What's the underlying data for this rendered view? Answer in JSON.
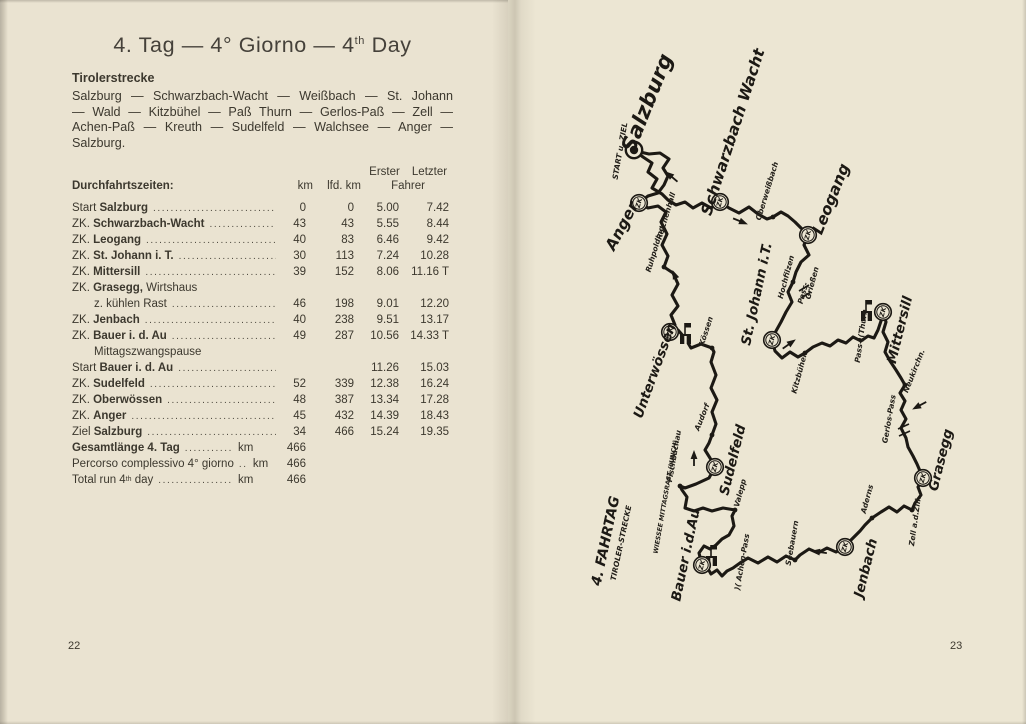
{
  "colors": {
    "page_left": "#eae3d1",
    "page_right": "#ece6d3",
    "ink": "#3c382e",
    "map_ink": "#1c1914"
  },
  "left_page": {
    "page_number": "22",
    "title": {
      "before": "4. Tag — 4° Giorno — 4",
      "sup": "th",
      "after": " Day"
    },
    "section_heading": "Tirolerstrecke",
    "route_paragraph": "Salzburg — Schwarzbach-Wacht — Weißbach — St. Johann — Wald — Kitzbühel — Paß Thurn — Gerlos-Paß — Zell — Achen-Paß — Kreuth — Sudelfeld — Walchsee — Anger — Salzburg.",
    "table": {
      "header": {
        "col1": "Durchfahrtszeiten:",
        "km": "km",
        "lfd": "lfd. km",
        "erster": "Erster",
        "letzter": "Letzter",
        "fahrer": "Fahrer"
      },
      "rows": [
        {
          "pre": "Start ",
          "bold": "Salzburg",
          "dots": 1,
          "km": "0",
          "lfd": "0",
          "e": "5.00",
          "l": "7.42"
        },
        {
          "pre": "ZK. ",
          "bold": "Schwarzbach-Wacht",
          "dots": 1,
          "km": "43",
          "lfd": "43",
          "e": "5.55",
          "l": "8.44"
        },
        {
          "pre": "ZK. ",
          "bold": "Leogang",
          "dots": 1,
          "km": "40",
          "lfd": "83",
          "e": "6.46",
          "l": "9.42"
        },
        {
          "pre": "ZK. ",
          "bold": "St. Johann i. T.",
          "dots": 1,
          "km": "30",
          "lfd": "113",
          "e": "7.24",
          "l": "10.28"
        },
        {
          "pre": "ZK. ",
          "bold": "Mittersill",
          "dots": 1,
          "km": "39",
          "lfd": "152",
          "e": "8.06",
          "l": "11.16 T"
        },
        {
          "pre": "ZK. ",
          "bold": "Grasegg,",
          "post": " Wirtshaus",
          "dots": 0
        },
        {
          "ind": 1,
          "pre": "z. kühlen Rast",
          "dots": 1,
          "km": "46",
          "lfd": "198",
          "e": "9.01",
          "l": "12.20"
        },
        {
          "pre": "ZK. ",
          "bold": "Jenbach",
          "dots": 1,
          "km": "40",
          "lfd": "238",
          "e": "9.51",
          "l": "13.17"
        },
        {
          "pre": "ZK. ",
          "bold": "Bauer i. d. Au",
          "dots": 1,
          "km": "49",
          "lfd": "287",
          "e": "10.56",
          "l": "14.33 T"
        },
        {
          "ind": 1,
          "pre": "Mittagszwangspause",
          "dots": 0
        },
        {
          "pre": "Start ",
          "bold": "Bauer i. d. Au",
          "dots": 1,
          "e": "11.26",
          "l": "15.03"
        },
        {
          "pre": "ZK. ",
          "bold": "Sudelfeld",
          "dots": 1,
          "km": "52",
          "lfd": "339",
          "e": "12.38",
          "l": "16.24"
        },
        {
          "pre": "ZK. ",
          "bold": "Oberwössen",
          "dots": 1,
          "km": "48",
          "lfd": "387",
          "e": "13.34",
          "l": "17.28"
        },
        {
          "pre": "ZK. ",
          "bold": "Anger",
          "dots": 1,
          "km": "45",
          "lfd": "432",
          "e": "14.39",
          "l": "18.43"
        },
        {
          "pre": "Ziel ",
          "bold": "Salzburg",
          "dots": 1,
          "km": "34",
          "lfd": "466",
          "e": "15.24",
          "l": "19.35"
        },
        {
          "bold": "Gesamtlänge 4. Tag",
          "dots": 1,
          "unit": "km",
          "km": "466"
        },
        {
          "pre": "Percorso complessivo 4° giorno",
          "dots": 1,
          "unit": "km",
          "km": "466"
        },
        {
          "pre": "Total run 4",
          "sup": "th",
          "post": " day",
          "dots": 1,
          "unit": "km",
          "km": "466"
        }
      ]
    }
  },
  "right_page": {
    "page_number": "23",
    "map": {
      "zk_label": "ZK",
      "route": "M634,150 L643,157 L652,163 L648,172 L657,179 L652,188 L662,194 L668,200 L676,205 L685,202 L693,208 L702,203 L711,208 L720,202 L729,208 L739,213 L749,207 L758,214 L767,219 L773,217 L781,212 L788,216 L795,222 L801,228 L808,235 L804,245 L809,255 L801,262 L796,272 L793,282 L788,292 L792,302 L786,312 L781,322 L776,331 L772,340 L775,351 L782,358 L790,352 L798,357 L805,353 L813,347 L822,343 L830,346 L838,340 L846,343 L853,337 L861,341 L868,336 L874,338 L878,330 L881,321 L883,312 L886,322 L883,332 L888,342 L885,352 L890,361 L896,370 L901,378 L905,385 L900,393 L905,401 L901,410 L906,419 L901,428 L906,438 L908,447 L913,456 L917,464 L920,471 L923,478 L918,487 L921,495 L915,503 L912,510 L904,506 L897,512 L889,507 L881,512 L875,516 L872,518 L865,525 L860,531 L854,537 L849,542 L845,547 L836,552 L827,548 L818,553 L809,549 L800,555 L795,560 L786,556 L777,562 L768,557 L758,563 L748,558 L740,563 L733,568 L727,571 L722,576 L717,570 L711,574 L707,567 L702,565 L699,553 L704,546 L710,549 L716,545 L722,539 L729,535 L734,526 L732,516 L735,510 L723,508 L712,511 L703,508 L694,511 L685,508 L687,497 L682,490 L680,486 L685,488 L696,484 L709,478 L715,467 L710,458 L705,450 L709,443 L712,435 L716,424 L712,412 L717,400 L711,388 L716,375 L711,362 L714,352 L712,348 L701,344 L691,348 L685,338 L678,330 L670,332 L675,325 L671,315 L678,306 L672,295 L678,284 L673,273 L664,267 L668,256 L662,245 L667,234 L661,222 L666,212 L658,206 L648,208 L639,203 L648,196 L658,193 L664,185 L668,176 L663,168 L669,159 L660,153 L649,154 L640,152 Z",
      "start_marker": {
        "x": 634,
        "y": 150
      },
      "checkpoints": [
        {
          "n": "anger",
          "x": 639,
          "y": 203
        },
        {
          "n": "schwarzbach-wacht",
          "x": 720,
          "y": 202
        },
        {
          "n": "leogang",
          "x": 808,
          "y": 235
        },
        {
          "n": "st-johann",
          "x": 772,
          "y": 340
        },
        {
          "n": "mittersill",
          "x": 883,
          "y": 312
        },
        {
          "n": "unterwoessen",
          "x": 670,
          "y": 332
        },
        {
          "n": "sudelfeld",
          "x": 715,
          "y": 467
        },
        {
          "n": "grasegg",
          "x": 923,
          "y": 478
        },
        {
          "n": "jenbach",
          "x": 845,
          "y": 547
        },
        {
          "n": "bauer-i-d-au",
          "x": 702,
          "y": 565
        }
      ],
      "towns": [
        {
          "n": "oberweissbach",
          "x": 773,
          "y": 217
        },
        {
          "n": "ruhpolding",
          "x": 664,
          "y": 267
        },
        {
          "n": "hochfilzen",
          "x": 793,
          "y": 282
        },
        {
          "n": "kitzbuehel",
          "x": 805,
          "y": 353
        },
        {
          "n": "koessen",
          "x": 712,
          "y": 348
        },
        {
          "n": "audorf",
          "x": 712,
          "y": 435
        },
        {
          "n": "fischbachau",
          "x": 680,
          "y": 486
        },
        {
          "n": "valepp",
          "x": 735,
          "y": 510
        },
        {
          "n": "neukirchen",
          "x": 905,
          "y": 385
        },
        {
          "n": "zell",
          "x": 912,
          "y": 510
        },
        {
          "n": "aderns",
          "x": 872,
          "y": 518
        },
        {
          "n": "seebauern",
          "x": 795,
          "y": 560
        }
      ],
      "buildings": [
        {
          "n": "unterwoessen",
          "x": 680,
          "y": 323
        },
        {
          "n": "mittersill",
          "x": 861,
          "y": 300
        },
        {
          "n": "bauer-i-d-au",
          "x": 706,
          "y": 545
        }
      ],
      "arrows": [
        {
          "x": 666,
          "y": 172,
          "a": -140
        },
        {
          "x": 747,
          "y": 224,
          "a": 22
        },
        {
          "x": 795,
          "y": 340,
          "a": -35
        },
        {
          "x": 913,
          "y": 409,
          "a": 152
        },
        {
          "x": 812,
          "y": 551,
          "a": 188
        },
        {
          "x": 694,
          "y": 451,
          "a": -90
        },
        {
          "x": 673,
          "y": 271,
          "a": -112
        }
      ],
      "pass_marks": [
        {
          "x1": 799,
          "y1": 291,
          "x2": 809,
          "y2": 285
        },
        {
          "x1": 801,
          "y1": 298,
          "x2": 811,
          "y2": 292
        },
        {
          "x1": 898,
          "y1": 429,
          "x2": 909,
          "y2": 424
        },
        {
          "x1": 899,
          "y1": 436,
          "x2": 910,
          "y2": 431
        }
      ],
      "labels": [
        {
          "t": "Salzburg",
          "x": 647,
          "y": 103,
          "r": -68,
          "s": 21,
          "c": "big"
        },
        {
          "t": "Schwarzbach Wacht",
          "x": 733,
          "y": 132,
          "r": -72,
          "s": 15.5,
          "c": "big"
        },
        {
          "t": "Leogang",
          "x": 831,
          "y": 199,
          "r": -68,
          "s": 15.5,
          "c": "big"
        },
        {
          "t": "Anger",
          "x": 622,
          "y": 226,
          "r": -62,
          "s": 15.5,
          "c": "big"
        },
        {
          "t": "St. Johann i.T.",
          "x": 757,
          "y": 294,
          "r": -78,
          "s": 13.5,
          "c": "big"
        },
        {
          "t": "Mittersill",
          "x": 900,
          "y": 330,
          "r": -76,
          "s": 13.5,
          "c": "big"
        },
        {
          "t": "Unterwössen",
          "x": 655,
          "y": 371,
          "r": -70,
          "s": 13.5,
          "c": "big"
        },
        {
          "t": "Sudelfeld",
          "x": 733,
          "y": 460,
          "r": -76,
          "s": 13.5,
          "c": "big"
        },
        {
          "t": "Grasegg",
          "x": 941,
          "y": 460,
          "r": -76,
          "s": 13.5,
          "c": "big"
        },
        {
          "t": "Jenbach",
          "x": 866,
          "y": 568,
          "r": -76,
          "s": 13.5,
          "c": "big"
        },
        {
          "t": "Bauer i.d.Au",
          "x": 686,
          "y": 555,
          "r": -78,
          "s": 13.5,
          "c": "big"
        },
        {
          "t": "4. FAHRTAG",
          "x": 606,
          "y": 541,
          "r": -78,
          "s": 14,
          "c": "big"
        },
        {
          "t": "TIROLER-STRECKE",
          "x": 621,
          "y": 543,
          "r": -78,
          "s": 7.5,
          "c": "sm"
        },
        {
          "t": "START u. ZIEL",
          "x": 620,
          "y": 151,
          "r": -80,
          "s": 7.5,
          "c": "sm"
        },
        {
          "t": "Oberweißbach",
          "x": 767,
          "y": 191,
          "r": -73,
          "s": 7.5,
          "c": "sm"
        },
        {
          "t": "Reichenhall",
          "x": 666,
          "y": 216,
          "r": -73,
          "s": 7.5,
          "c": "sm"
        },
        {
          "t": "Ruhpolding",
          "x": 655,
          "y": 249,
          "r": -73,
          "s": 7.5,
          "c": "sm"
        },
        {
          "t": "Hochfilzen",
          "x": 786,
          "y": 277,
          "r": -75,
          "s": 7.5,
          "c": "sm"
        },
        {
          "t": "Pass-",
          "x": 803,
          "y": 293,
          "r": -75,
          "s": 7.5,
          "c": "sm"
        },
        {
          "t": "Grießen",
          "x": 812,
          "y": 283,
          "r": -75,
          "s": 7.5,
          "c": "sm"
        },
        {
          "t": "Pass-)(Thurn",
          "x": 861,
          "y": 336,
          "r": -82,
          "s": 7.5,
          "c": "sm"
        },
        {
          "t": "Kitzbühel",
          "x": 799,
          "y": 374,
          "r": -75,
          "s": 7.5,
          "c": "sm"
        },
        {
          "t": "Kössen",
          "x": 706,
          "y": 331,
          "r": -72,
          "s": 7.5,
          "c": "sm"
        },
        {
          "t": "Audorf",
          "x": 702,
          "y": 417,
          "r": -68,
          "s": 7.5,
          "c": "sm"
        },
        {
          "t": "Fischbachau",
          "x": 674,
          "y": 456,
          "r": -80,
          "s": 7.5,
          "c": "sm"
        },
        {
          "t": "Valepp",
          "x": 740,
          "y": 493,
          "r": -75,
          "s": 7.5,
          "c": "sm"
        },
        {
          "t": "Neukirchn.",
          "x": 914,
          "y": 371,
          "r": -68,
          "s": 7.5,
          "c": "sm"
        },
        {
          "t": "Gerlos-Pass",
          "x": 889,
          "y": 419,
          "r": -80,
          "s": 7.5,
          "c": "sm"
        },
        {
          "t": "Zell a.d.Zill.",
          "x": 915,
          "y": 521,
          "r": -82,
          "s": 7.5,
          "c": "sm"
        },
        {
          "t": "Aderns",
          "x": 867,
          "y": 499,
          "r": -75,
          "s": 7.5,
          "c": "sm"
        },
        {
          "t": "Seebauern",
          "x": 792,
          "y": 543,
          "r": -80,
          "s": 7.5,
          "c": "sm"
        },
        {
          "t": ")( Achen-Pass",
          "x": 742,
          "y": 562,
          "r": -80,
          "s": 7.5,
          "c": "sm"
        },
        {
          "t": "WIESSEE MITTAGSRAST (LUNCH)",
          "x": 666,
          "y": 497,
          "r": -80,
          "s": 6.3,
          "c": "sm"
        }
      ]
    }
  }
}
